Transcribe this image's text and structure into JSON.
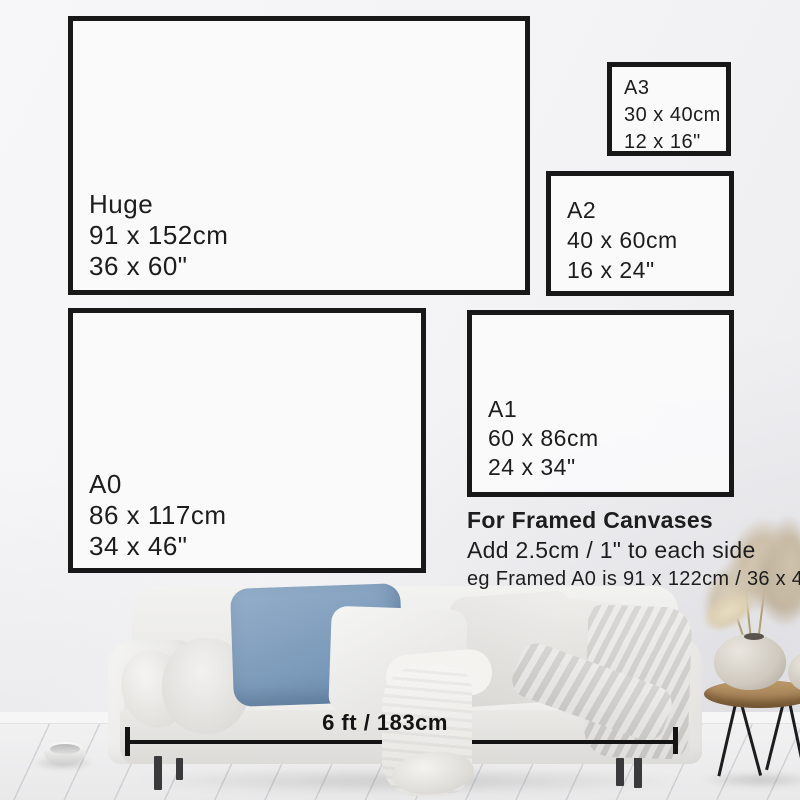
{
  "size_guide": {
    "boxes": [
      {
        "id": "huge",
        "label": "Huge",
        "cm": "91 x 152cm",
        "inches": "36 x 60\""
      },
      {
        "id": "a3",
        "label": "A3",
        "cm": "30 x 40cm",
        "inches": "12 x 16\""
      },
      {
        "id": "a2",
        "label": "A2",
        "cm": "40 x 60cm",
        "inches": "16 x 24\""
      },
      {
        "id": "a0",
        "label": "A0",
        "cm": "86 x 117cm",
        "inches": "34 x 46\""
      },
      {
        "id": "a1",
        "label": "A1",
        "cm": "60 x 86cm",
        "inches": "24 x 34\""
      }
    ],
    "framed_note": {
      "line1": "For Framed Canvases",
      "line2": "Add 2.5cm / 1\" to each side",
      "line3": "eg Framed A0 is 91 x 122cm / 36 x 48\""
    },
    "sofa_width_label": "6 ft / 183cm"
  },
  "colors": {
    "frame_border": "#181818",
    "text": "#1d1d1d",
    "wall": "#f3f3f5",
    "blue_pillow": "#7e9cbb",
    "table_wood": "#a8855a"
  }
}
